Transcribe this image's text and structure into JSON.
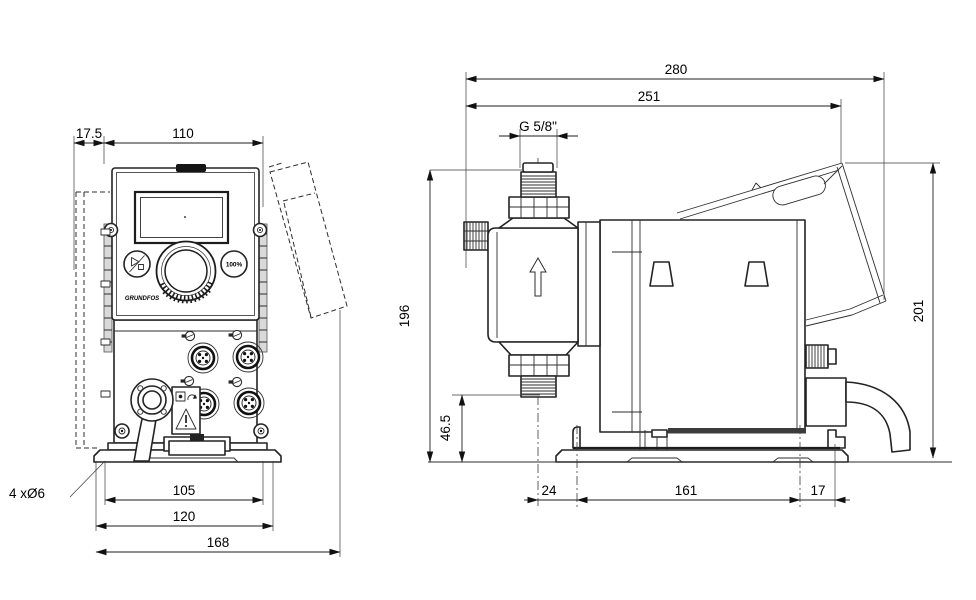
{
  "page": {
    "background": "#ffffff",
    "line_color": "#1c1c1c"
  },
  "views": {
    "front": {
      "dims": {
        "bracket_depth": "17.5",
        "housing_width": "110",
        "hole_spacing": "105",
        "plate_width": "120",
        "overall_width": "168",
        "mounting_holes": "4 xØ6"
      },
      "panel": {
        "logo": "GRUNDFOS",
        "capacity_button": "100%"
      }
    },
    "side": {
      "dims": {
        "overall_depth": "280",
        "housing_depth": "251",
        "thread": "G 5/8\"",
        "height_connector": "196",
        "valve_height": "46.5",
        "plate_offset_front": "24",
        "plate_length": "161",
        "plate_offset_rear": "17",
        "overall_height": "201"
      }
    }
  }
}
